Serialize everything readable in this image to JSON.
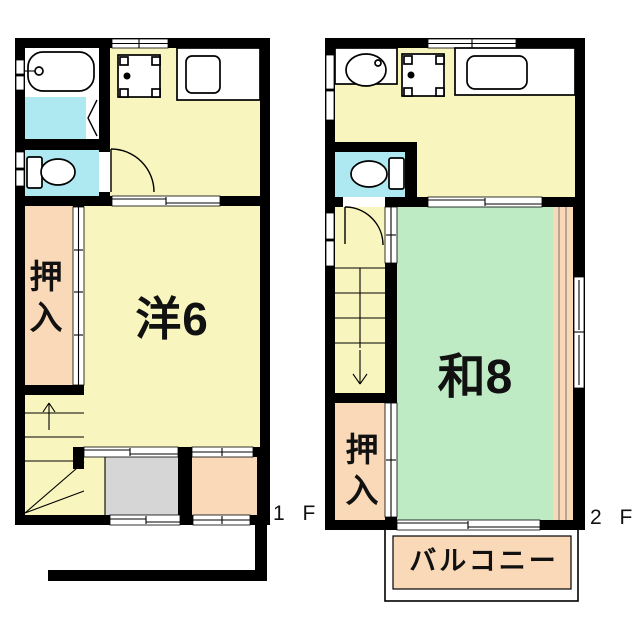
{
  "plan": {
    "floor1": {
      "label": "1 F",
      "room_western": "洋6",
      "closet": "押入"
    },
    "floor2": {
      "label": "2 F",
      "room_japanese": "和8",
      "closet": "押入",
      "balcony": "バルコニー"
    }
  },
  "colors": {
    "wall": "#000000",
    "floor_yellow": "#F8F6BE",
    "wet_area_cyan": "#AEE9F2",
    "closet_peach": "#F9D9B8",
    "tatami_green": "#BFEBC4",
    "entry_gray": "#D6D6D6",
    "background": "#FFFFFF"
  }
}
